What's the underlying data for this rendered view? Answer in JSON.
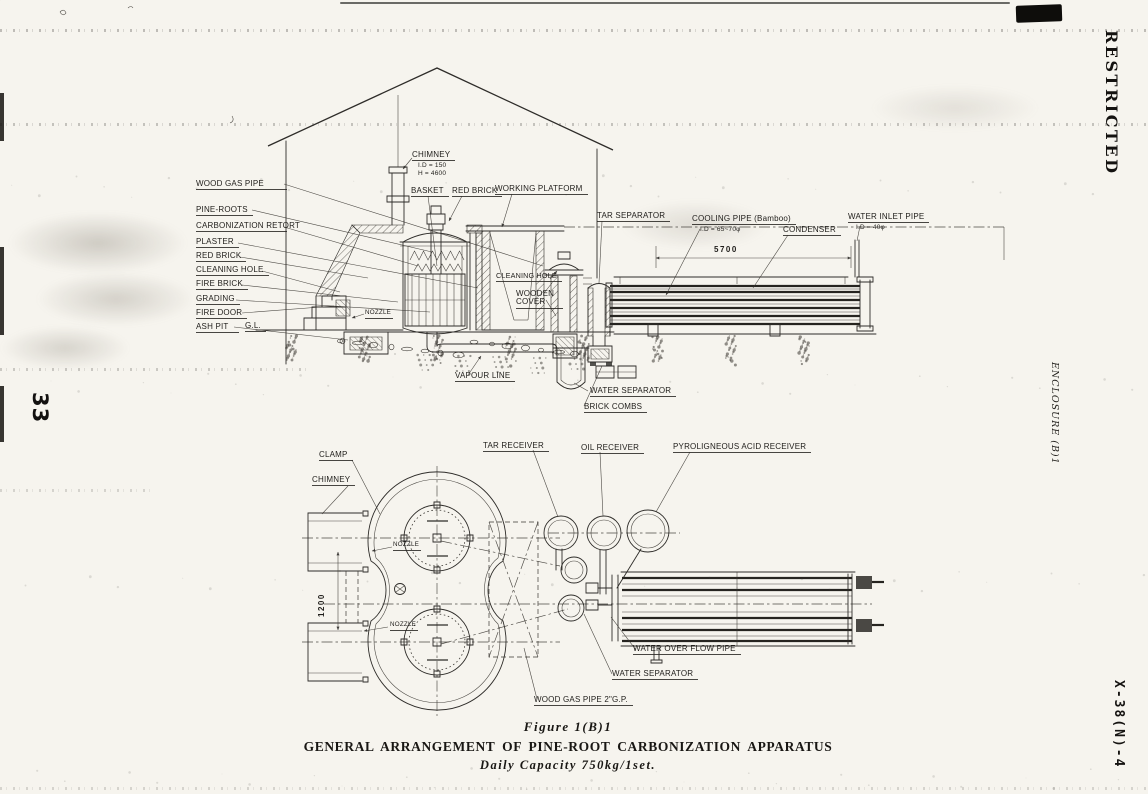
{
  "margins": {
    "page_number": "33",
    "classification": "RESTRICTED",
    "enclosure": "ENCLOSURE (B)1",
    "doc_ref": "X-38(N)-4"
  },
  "caption": {
    "figure": "Figure 1(B)1",
    "title": "GENERAL ARRANGEMENT OF PINE-ROOT CARBONIZATION APPARATUS",
    "subtitle": "Daily Capacity 750kg/1set."
  },
  "section_view": {
    "labels": {
      "wood_gas_pipe": "WOOD GAS PIPE",
      "pine_roots": "PINE-ROOTS",
      "carbonization_retort": "CARBONIZATION RETORT",
      "plaster": "PLASTER",
      "red_brick": "RED BRICK",
      "cleaning_hole": "CLEANING HOLE",
      "fire_brick": "FIRE BRICK",
      "grading": "GRADING",
      "fire_door": "FIRE DOOR",
      "ash_pit": "ASH PIT",
      "ground_level": "G.L.",
      "chimney": "CHIMNEY",
      "chimney_id": "I.D = 150",
      "chimney_height": "H = 4600",
      "basket": "BASKET",
      "red_brick_top": "RED BRICK",
      "working_platform": "WORKING PLATFORM",
      "tar_separator": "TAR SEPARATOR",
      "cooling_pipe": "COOLING PIPE (Bamboo)",
      "cooling_pipe_id": "I.D = 65~70φ",
      "condenser": "CONDENSER",
      "water_inlet_pipe": "WATER INLET PIPE",
      "water_inlet_id": "I.D = 40φ",
      "cleaning_hole_mid": "CLEANING HOLE",
      "wooden_cover": "WOODEN COVER",
      "nozzle": "NOZZLE",
      "vapour_line": "VAPOUR LINE",
      "water_separator": "WATER SEPARATOR",
      "brick_combs": "BRICK COMBS",
      "condenser_length_dim": "5700"
    }
  },
  "plan_view": {
    "labels": {
      "clamp": "CLAMP",
      "chimney": "CHIMNEY",
      "tar_receiver": "TAR RECEIVER",
      "oil_receiver": "OIL RECEIVER",
      "pyroligneous_acid_receiver": "PYROLIGNEOUS ACID RECEIVER",
      "nozzle_upper": "NOZZLE",
      "nozzle_lower": "NOZZLE",
      "retort_spacing_dim": "1200",
      "water_overflow_pipe": "WATER OVER FLOW PIPE",
      "water_separator": "WATER SEPARATOR",
      "wood_gas_pipe": "WOOD GAS PIPE 2\"G.P."
    }
  }
}
